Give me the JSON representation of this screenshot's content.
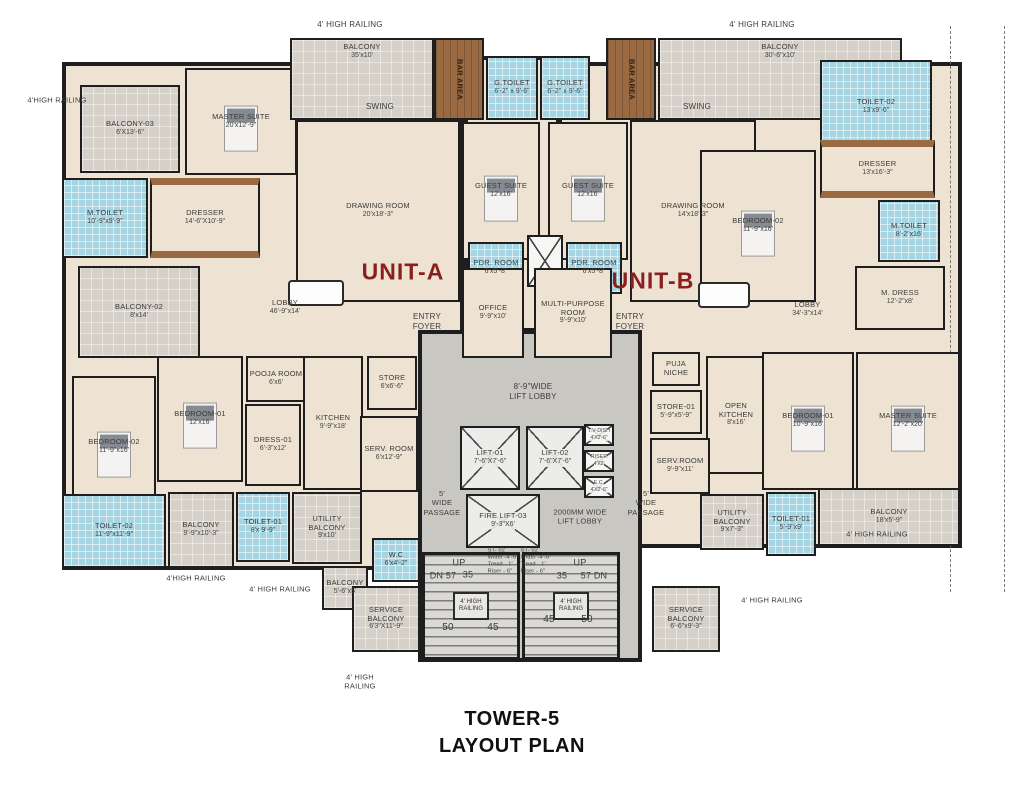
{
  "title": {
    "line1": "TOWER-5",
    "line2": "LAYOUT PLAN"
  },
  "units": [
    {
      "label": "UNIT-A"
    },
    {
      "label": "UNIT-B"
    }
  ],
  "colors": {
    "wall": "#1e1e1e",
    "floor": "#eee3d2",
    "balcony": "#d5d0c8",
    "toilet": "#a5d5e3",
    "wood": "#9a6a42",
    "core": "#c9c7c2",
    "unit_label": "#8b1f1f"
  },
  "stairs": {
    "rail_label": "4' HIGH RAILING"
  },
  "rooms": [
    {
      "id": "balcony-03",
      "label": "BALCONY-03",
      "dims": "6'X13'-6\"",
      "type": "balcony",
      "x": 80,
      "y": 85,
      "w": 100,
      "h": 88
    },
    {
      "id": "master-suite-a",
      "label": "MASTER SUITE",
      "dims": "20'x12'-9\"",
      "type": "room",
      "bed": true,
      "x": 185,
      "y": 68,
      "w": 112,
      "h": 107
    },
    {
      "id": "dresser-a",
      "label": "DRESSER",
      "dims": "14'-6\"X10'-9\"",
      "type": "wardrobe",
      "x": 150,
      "y": 178,
      "w": 110,
      "h": 80
    },
    {
      "id": "m-toilet-a",
      "label": "M.TOILET",
      "dims": "10'-9\"x9'-9\"",
      "type": "toilet",
      "x": 62,
      "y": 178,
      "w": 86,
      "h": 80
    },
    {
      "id": "balcony-top-a",
      "label": "BALCONY",
      "dims": "35'x10'",
      "type": "balcony",
      "labelTop": true,
      "x": 290,
      "y": 38,
      "w": 144,
      "h": 82
    },
    {
      "id": "bar-area-a",
      "label": "BAR AREA",
      "type": "wood",
      "vertical": true,
      "x": 434,
      "y": 38,
      "w": 50,
      "h": 82
    },
    {
      "id": "g-toilet-a",
      "label": "G.TOILET",
      "dims": "6'-2\" x 9'-6\"",
      "type": "toilet",
      "x": 486,
      "y": 56,
      "w": 52,
      "h": 64
    },
    {
      "id": "g-toilet-b",
      "label": "G.TOILET",
      "dims": "6'-2\" x 9'-6\"",
      "type": "toilet",
      "x": 540,
      "y": 56,
      "w": 50,
      "h": 64
    },
    {
      "id": "bar-area-b",
      "label": "BAR AREA",
      "type": "wood",
      "vertical": true,
      "x": 606,
      "y": 38,
      "w": 50,
      "h": 82
    },
    {
      "id": "balcony-top-b",
      "label": "BALCONY",
      "dims": "30'-6\"x10'",
      "type": "balcony",
      "labelTop": true,
      "x": 658,
      "y": 38,
      "w": 244,
      "h": 82
    },
    {
      "id": "drawing-room-a",
      "label": "DRAWING ROOM",
      "dims": "20'x18'-3\"",
      "type": "room",
      "x": 296,
      "y": 120,
      "w": 164,
      "h": 182
    },
    {
      "id": "guest-suite-a",
      "label": "GUEST SUITE",
      "dims": "12'x16'",
      "type": "room",
      "bed": true,
      "x": 462,
      "y": 122,
      "w": 78,
      "h": 138
    },
    {
      "id": "guest-suite-b",
      "label": "GUEST SUITE",
      "dims": "12'x16'",
      "type": "room",
      "bed": true,
      "x": 548,
      "y": 122,
      "w": 80,
      "h": 138
    },
    {
      "id": "drawing-room-b",
      "label": "DRAWING ROOM",
      "dims": "14'x18'-3\"",
      "type": "room",
      "x": 630,
      "y": 120,
      "w": 126,
      "h": 182
    },
    {
      "id": "pdr-room-a",
      "label": "PDR. ROOM",
      "dims": "6'x5'-8\"",
      "type": "toilet",
      "x": 468,
      "y": 242,
      "w": 56,
      "h": 52
    },
    {
      "id": "shaft-mid",
      "type": "shaft",
      "x": 527,
      "y": 235,
      "w": 36,
      "h": 52
    },
    {
      "id": "pdr-room-b",
      "label": "PDR. ROOM",
      "dims": "6'x5'-8\"",
      "type": "toilet",
      "x": 566,
      "y": 242,
      "w": 56,
      "h": 52
    },
    {
      "id": "toilet-02-b",
      "label": "TOILET-02",
      "dims": "13'x9'-6\"",
      "type": "toilet",
      "x": 820,
      "y": 60,
      "w": 112,
      "h": 94
    },
    {
      "id": "dresser-b",
      "label": "DRESSER",
      "dims": "13'x16'-3\"",
      "type": "wardrobe",
      "x": 820,
      "y": 140,
      "w": 115,
      "h": 58
    },
    {
      "id": "m-toilet-b",
      "label": "M.TOILET",
      "dims": "8'-2\"x16'",
      "type": "toilet",
      "x": 878,
      "y": 200,
      "w": 62,
      "h": 62
    },
    {
      "id": "bedroom-02-b",
      "label": "BEDROOM-02",
      "dims": "11'-9\"x16'",
      "type": "room",
      "bed": true,
      "x": 700,
      "y": 150,
      "w": 116,
      "h": 152
    },
    {
      "id": "lobby-a",
      "label": "LOBBY",
      "dims": "46'-9\"x14'",
      "type": "open",
      "x": 225,
      "y": 285,
      "w": 120,
      "h": 45
    },
    {
      "id": "lobby-b",
      "label": "LOBBY",
      "dims": "34'-3\"x14'",
      "type": "open",
      "x": 760,
      "y": 290,
      "w": 95,
      "h": 40
    },
    {
      "id": "balcony-02",
      "label": "BALCONY-02",
      "dims": "8'x14'",
      "type": "balcony",
      "x": 78,
      "y": 266,
      "w": 122,
      "h": 92
    },
    {
      "id": "office",
      "label": "OFFICE",
      "dims": "9'-9\"x10'",
      "type": "room",
      "x": 462,
      "y": 268,
      "w": 62,
      "h": 90
    },
    {
      "id": "multi-purpose-room",
      "label": "MULTI-PURPOSE ROOM",
      "dims": "9'-9\"x10'",
      "type": "room",
      "x": 534,
      "y": 268,
      "w": 78,
      "h": 90
    },
    {
      "id": "m-dress",
      "label": "M. DRESS",
      "dims": "12'-2\"x8'",
      "type": "room",
      "x": 855,
      "y": 266,
      "w": 90,
      "h": 64
    },
    {
      "id": "pooja-room",
      "label": "POOJA ROOM",
      "dims": "6'x6'",
      "type": "room",
      "x": 246,
      "y": 356,
      "w": 60,
      "h": 46
    },
    {
      "id": "bedroom-01-a",
      "label": "BEDROOM-01",
      "dims": "12'x16'",
      "type": "room",
      "bed": true,
      "x": 157,
      "y": 356,
      "w": 86,
      "h": 126
    },
    {
      "id": "bedroom-02-a",
      "label": "BEDROOM-02",
      "dims": "11'-9\"x16'",
      "type": "room",
      "bed": true,
      "x": 72,
      "y": 376,
      "w": 84,
      "h": 142
    },
    {
      "id": "dress-01",
      "label": "DRESS-01",
      "dims": "6'-3\"x12'",
      "type": "room",
      "x": 245,
      "y": 404,
      "w": 56,
      "h": 82
    },
    {
      "id": "kitchen",
      "label": "KITCHEN",
      "dims": "9'-9\"x18'",
      "type": "room",
      "x": 303,
      "y": 356,
      "w": 60,
      "h": 134
    },
    {
      "id": "store-a",
      "label": "STORE",
      "dims": "6'x6'-6\"",
      "type": "room",
      "x": 367,
      "y": 356,
      "w": 50,
      "h": 54
    },
    {
      "id": "serv-room-a",
      "label": "SERV. ROOM",
      "dims": "6'x12'-9\"",
      "type": "room",
      "x": 360,
      "y": 416,
      "w": 58,
      "h": 76
    },
    {
      "id": "toilet-02-a",
      "label": "TOILET-02",
      "dims": "11'-9\"x11'-9\"",
      "type": "toilet",
      "x": 62,
      "y": 494,
      "w": 104,
      "h": 74
    },
    {
      "id": "balcony-bl",
      "label": "BALCONY",
      "dims": "9'-9\"x10'-3\"",
      "type": "balcony",
      "x": 168,
      "y": 492,
      "w": 66,
      "h": 76
    },
    {
      "id": "toilet-01-a",
      "label": "TOILET-01",
      "dims": "8'x 9'-9\"",
      "type": "toilet",
      "x": 236,
      "y": 492,
      "w": 54,
      "h": 70
    },
    {
      "id": "utility-balcony-a",
      "label": "UTILITY BALCONY",
      "dims": "9'x10'",
      "type": "balcony",
      "x": 292,
      "y": 492,
      "w": 70,
      "h": 72
    },
    {
      "id": "balcony-small-a",
      "label": "BALCONY",
      "dims": "5'-6\"x5'",
      "type": "balcony",
      "x": 322,
      "y": 566,
      "w": 46,
      "h": 44
    },
    {
      "id": "wc",
      "label": "W.C",
      "dims": "6'x4'-2\"",
      "type": "toilet",
      "x": 372,
      "y": 538,
      "w": 48,
      "h": 44
    },
    {
      "id": "service-balcony-a",
      "label": "SERVICE BALCONY",
      "dims": "6'3\"X11'-9\"",
      "type": "balcony",
      "x": 352,
      "y": 586,
      "w": 68,
      "h": 66
    },
    {
      "id": "lift-01",
      "label": "LIFT-01",
      "dims": "7'-6\"X7'-6\"",
      "type": "lift",
      "x": 460,
      "y": 426,
      "w": 60,
      "h": 64
    },
    {
      "id": "lift-02",
      "label": "LIFT-02",
      "dims": "7'-6\"X7'-6\"",
      "type": "lift",
      "x": 526,
      "y": 426,
      "w": 58,
      "h": 64
    },
    {
      "id": "fire-lift-03",
      "label": "FIRE LIFT-03",
      "dims": "9'-3\"X6'",
      "type": "lift",
      "x": 466,
      "y": 494,
      "w": 74,
      "h": 54
    },
    {
      "id": "shaft-tv-dish",
      "label": "T.V-DISH",
      "dims": "4'X2'-6\"",
      "type": "shaft",
      "x": 584,
      "y": 424,
      "w": 30,
      "h": 22
    },
    {
      "id": "shaft-riser",
      "label": "RISER",
      "dims": "4'X2'",
      "type": "shaft",
      "x": 584,
      "y": 450,
      "w": 30,
      "h": 22
    },
    {
      "id": "shaft-ec",
      "label": "E.C.",
      "dims": "4'X2'-6\"",
      "type": "shaft",
      "x": 584,
      "y": 476,
      "w": 30,
      "h": 22
    },
    {
      "id": "stair-left",
      "type": "stair",
      "x": 422,
      "y": 552,
      "w": 98,
      "h": 108
    },
    {
      "id": "stair-right",
      "type": "stair",
      "x": 522,
      "y": 552,
      "w": 98,
      "h": 108
    },
    {
      "id": "puja-niche",
      "label": "PUJA\nNICHE",
      "type": "room",
      "x": 652,
      "y": 352,
      "w": 48,
      "h": 34
    },
    {
      "id": "store-01",
      "label": "STORE-01",
      "dims": "5'-9\"x5'-9\"",
      "type": "room",
      "x": 650,
      "y": 390,
      "w": 52,
      "h": 44
    },
    {
      "id": "open-kitchen",
      "label": "OPEN KITCHEN",
      "dims": "8'x16'",
      "type": "room",
      "x": 706,
      "y": 356,
      "w": 60,
      "h": 118
    },
    {
      "id": "serv-room-b",
      "label": "SERV.ROOM",
      "dims": "9'-9\"x11'",
      "type": "room",
      "x": 650,
      "y": 438,
      "w": 60,
      "h": 56
    },
    {
      "id": "bedroom-01-b",
      "label": "BEDROOM-01",
      "dims": "10'-9\"x16'",
      "type": "room",
      "bed": true,
      "x": 762,
      "y": 352,
      "w": 92,
      "h": 138
    },
    {
      "id": "master-suite-b",
      "label": "MASTER SUITE",
      "dims": "12'-2\"x20'",
      "type": "room",
      "bed": true,
      "x": 856,
      "y": 352,
      "w": 104,
      "h": 138
    },
    {
      "id": "utility-balcony-b",
      "label": "UTILITY BALCONY",
      "dims": "9'x7'-3\"",
      "type": "balcony",
      "x": 700,
      "y": 494,
      "w": 64,
      "h": 56
    },
    {
      "id": "toilet-01-b",
      "label": "TOILET-01",
      "dims": "5'-9\"x9'",
      "type": "toilet",
      "x": 766,
      "y": 492,
      "w": 50,
      "h": 64
    },
    {
      "id": "balcony-br",
      "label": "BALCONY",
      "dims": "18'x5'-9\"",
      "type": "balcony",
      "x": 818,
      "y": 488,
      "w": 142,
      "h": 58
    },
    {
      "id": "service-balcony-b",
      "label": "SERVICE BALCONY",
      "dims": "6'-6\"x9'-3\"",
      "type": "balcony",
      "x": 652,
      "y": 586,
      "w": 68,
      "h": 66
    }
  ],
  "annotations": [
    {
      "id": "railing-top-left",
      "text": "4' HIGH RAILING",
      "x": 350,
      "y": 25,
      "size": 8
    },
    {
      "id": "railing-top-right",
      "text": "4' HIGH RAILING",
      "x": 762,
      "y": 25,
      "size": 8
    },
    {
      "id": "railing-left",
      "text": "4'HIGH RAILING",
      "x": 57,
      "y": 100,
      "size": 7.5
    },
    {
      "id": "swing-a",
      "text": "SWING",
      "x": 380,
      "y": 107,
      "size": 8
    },
    {
      "id": "swing-b",
      "text": "SWING",
      "x": 697,
      "y": 107,
      "size": 8
    },
    {
      "id": "entry-foyer-a",
      "text": "ENTRY\nFOYER",
      "x": 427,
      "y": 322,
      "size": 8
    },
    {
      "id": "entry-foyer-b",
      "text": "ENTRY\nFOYER",
      "x": 630,
      "y": 322,
      "size": 8
    },
    {
      "id": "lift-lobby-width",
      "text": "8'-9\"WIDE\nLIFT LOBBY",
      "x": 533,
      "y": 392,
      "size": 8
    },
    {
      "id": "lift-lobby-2000",
      "text": "2000MM WIDE\nLIFT LOBBY",
      "x": 580,
      "y": 517,
      "size": 7.5
    },
    {
      "id": "passage-left",
      "text": "5'\nWIDE\nPASSAGE",
      "x": 442,
      "y": 503,
      "size": 7.5
    },
    {
      "id": "passage-right",
      "text": "5'\nWIDE\nPASSAGE",
      "x": 646,
      "y": 503,
      "size": 7.5
    },
    {
      "id": "stair-spec-left",
      "text": "ST- 02\nWidth -4'-6\"\nTread - 1'\nRiser - 6\"",
      "x": 503,
      "y": 561,
      "size": 5.5,
      "align": "left"
    },
    {
      "id": "stair-spec-right",
      "text": "ST- 02\nWidth -4'-6\"\nTread - 1'\nRiser - 6\"",
      "x": 536,
      "y": 561,
      "size": 5.5,
      "align": "left"
    },
    {
      "id": "up-left",
      "text": "UP",
      "x": 459,
      "y": 563,
      "size": 9
    },
    {
      "id": "dn-left",
      "text": "DN 57",
      "x": 443,
      "y": 576,
      "size": 9
    },
    {
      "id": "n35-left",
      "text": "35",
      "x": 468,
      "y": 575,
      "size": 9
    },
    {
      "id": "n50-left",
      "text": "50",
      "x": 448,
      "y": 628,
      "size": 10
    },
    {
      "id": "n45-left",
      "text": "45",
      "x": 493,
      "y": 628,
      "size": 10
    },
    {
      "id": "up-right",
      "text": "UP",
      "x": 580,
      "y": 563,
      "size": 9
    },
    {
      "id": "n35-right",
      "text": "35",
      "x": 562,
      "y": 576,
      "size": 9
    },
    {
      "id": "dn-right",
      "text": "57 DN",
      "x": 594,
      "y": 576,
      "size": 9
    },
    {
      "id": "n45-right",
      "text": "45",
      "x": 549,
      "y": 620,
      "size": 10
    },
    {
      "id": "n50-right",
      "text": "50",
      "x": 587,
      "y": 620,
      "size": 10
    },
    {
      "id": "railing-bottom-1",
      "text": "4'HIGH RAILING",
      "x": 196,
      "y": 578,
      "size": 7.5
    },
    {
      "id": "railing-bottom-2",
      "text": "4' HIGH RAILING",
      "x": 280,
      "y": 589,
      "size": 7.5
    },
    {
      "id": "railing-bottom-center",
      "text": "4' HIGH\nRAILING",
      "x": 360,
      "y": 682,
      "size": 7.5
    },
    {
      "id": "railing-right-1",
      "text": "4' HIGH RAILING",
      "x": 877,
      "y": 534,
      "size": 7.5
    },
    {
      "id": "railing-right-2",
      "text": "4' HIGH RAILING",
      "x": 772,
      "y": 600,
      "size": 7.5
    }
  ],
  "furnishings": [
    {
      "id": "dining-table-a",
      "type": "dtable",
      "x": 288,
      "y": 280,
      "w": 56,
      "h": 26
    },
    {
      "id": "dining-table-b",
      "type": "dtable",
      "x": 698,
      "y": 282,
      "w": 52,
      "h": 26
    }
  ]
}
